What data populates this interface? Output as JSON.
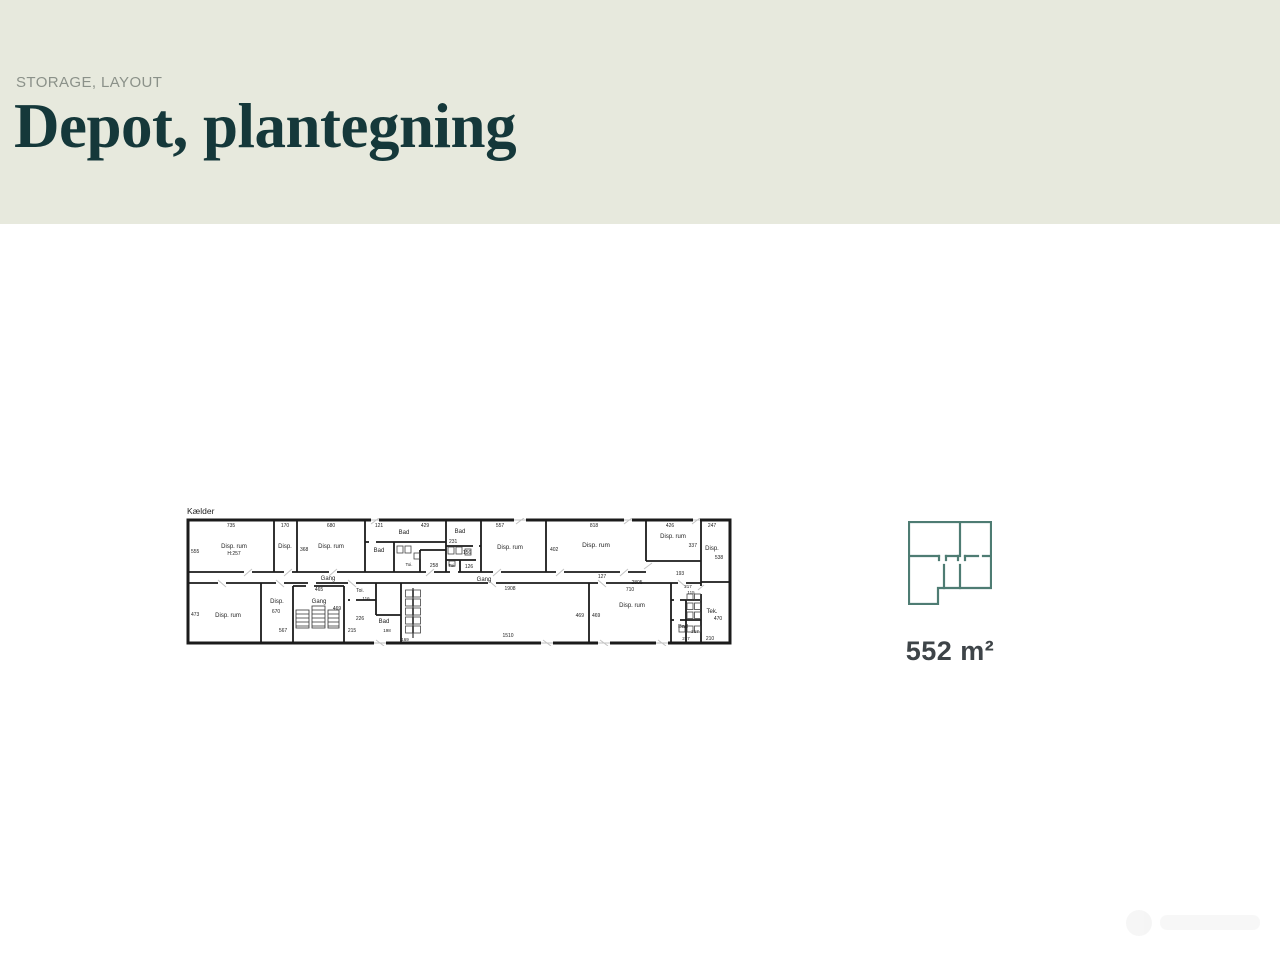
{
  "header": {
    "eyebrow": "STORAGE, LAYOUT",
    "title": "Depot, plantegning",
    "background": "#e7e9dd",
    "eyebrow_color": "#8b9189",
    "title_color": "#15383a"
  },
  "floorplan": {
    "name_label": "Kælder",
    "line_color": "#1b1b1b",
    "labels": [
      {
        "t": "735",
        "x": 43,
        "y": 7,
        "s": 5
      },
      {
        "t": "555",
        "x": 3,
        "y": 33,
        "s": 5,
        "a": "start"
      },
      {
        "t": "Disp. rum",
        "x": 46,
        "y": 28,
        "s": 6
      },
      {
        "t": "H:257",
        "x": 46,
        "y": 35,
        "s": 5
      },
      {
        "t": "170",
        "x": 97,
        "y": 7,
        "s": 5
      },
      {
        "t": "Disp.",
        "x": 97,
        "y": 28,
        "s": 6
      },
      {
        "t": "368",
        "x": 112,
        "y": 31,
        "s": 5,
        "a": "start"
      },
      {
        "t": "680",
        "x": 143,
        "y": 7,
        "s": 5
      },
      {
        "t": "Disp. rum",
        "x": 143,
        "y": 28,
        "s": 6
      },
      {
        "t": "121",
        "x": 191,
        "y": 7,
        "s": 5
      },
      {
        "t": "Bad",
        "x": 216,
        "y": 14,
        "s": 6
      },
      {
        "t": "429",
        "x": 237,
        "y": 7,
        "s": 5
      },
      {
        "t": "Bad",
        "x": 191,
        "y": 32,
        "s": 6
      },
      {
        "t": "Toi.",
        "x": 221,
        "y": 46,
        "s": 4.5
      },
      {
        "t": "258",
        "x": 246,
        "y": 47,
        "s": 5
      },
      {
        "t": "Bad",
        "x": 272,
        "y": 13,
        "s": 6
      },
      {
        "t": "231",
        "x": 261,
        "y": 23,
        "s": 5,
        "a": "start"
      },
      {
        "t": "156",
        "x": 279,
        "y": 34,
        "s": 5
      },
      {
        "t": "Toi.",
        "x": 264,
        "y": 47,
        "s": 4.5
      },
      {
        "t": "126",
        "x": 281,
        "y": 48,
        "s": 5
      },
      {
        "t": "557",
        "x": 312,
        "y": 7,
        "s": 5
      },
      {
        "t": "Disp. rum",
        "x": 322,
        "y": 29,
        "s": 6
      },
      {
        "t": "402",
        "x": 362,
        "y": 31,
        "s": 5,
        "a": "start"
      },
      {
        "t": "818",
        "x": 406,
        "y": 7,
        "s": 5
      },
      {
        "t": "Disp. rum",
        "x": 408,
        "y": 27,
        "s": 6.5
      },
      {
        "t": "426",
        "x": 482,
        "y": 7,
        "s": 5
      },
      {
        "t": "Disp. rum",
        "x": 485,
        "y": 18,
        "s": 6
      },
      {
        "t": "337",
        "x": 509,
        "y": 27,
        "s": 5,
        "a": "end"
      },
      {
        "t": "247",
        "x": 524,
        "y": 7,
        "s": 5
      },
      {
        "t": "Disp.",
        "x": 524,
        "y": 30,
        "s": 6
      },
      {
        "t": "538",
        "x": 531,
        "y": 39,
        "s": 5
      },
      {
        "t": "Gang",
        "x": 140,
        "y": 60,
        "s": 6
      },
      {
        "t": "Gang",
        "x": 296,
        "y": 61,
        "s": 6
      },
      {
        "t": "127",
        "x": 414,
        "y": 58,
        "s": 5
      },
      {
        "t": "2805",
        "x": 449,
        "y": 64,
        "s": 5
      },
      {
        "t": "193",
        "x": 492,
        "y": 55,
        "s": 5
      },
      {
        "t": "1908",
        "x": 322,
        "y": 70,
        "s": 5
      },
      {
        "t": "473",
        "x": 3,
        "y": 96,
        "s": 5,
        "a": "start"
      },
      {
        "t": "Disp. rum",
        "x": 40,
        "y": 97,
        "s": 6
      },
      {
        "t": "Disp.",
        "x": 89,
        "y": 83,
        "s": 6
      },
      {
        "t": "670",
        "x": 88,
        "y": 93,
        "s": 5
      },
      {
        "t": "567",
        "x": 95,
        "y": 112,
        "s": 5
      },
      {
        "t": "465",
        "x": 131,
        "y": 71,
        "s": 5
      },
      {
        "t": "Gang",
        "x": 131,
        "y": 83,
        "s": 6
      },
      {
        "t": "469",
        "x": 149,
        "y": 90,
        "s": 5
      },
      {
        "t": "Toi.",
        "x": 172,
        "y": 72,
        "s": 5
      },
      {
        "t": "116",
        "x": 178,
        "y": 80,
        "s": 4.5
      },
      {
        "t": "226",
        "x": 172,
        "y": 100,
        "s": 5
      },
      {
        "t": "215",
        "x": 164,
        "y": 112,
        "s": 5
      },
      {
        "t": "Bad",
        "x": 196,
        "y": 103,
        "s": 6
      },
      {
        "t": "198",
        "x": 199,
        "y": 112,
        "s": 4.5
      },
      {
        "t": "169",
        "x": 217,
        "y": 121,
        "s": 4.5
      },
      {
        "t": "469",
        "x": 396,
        "y": 97,
        "s": 5,
        "a": "end"
      },
      {
        "t": "469",
        "x": 404,
        "y": 97,
        "s": 5,
        "a": "start"
      },
      {
        "t": "710",
        "x": 442,
        "y": 71,
        "s": 5
      },
      {
        "t": "Disp. rum",
        "x": 444,
        "y": 87,
        "s": 6
      },
      {
        "t": "1510",
        "x": 320,
        "y": 117,
        "s": 5
      },
      {
        "t": "217",
        "x": 500,
        "y": 68,
        "s": 4.5
      },
      {
        "t": "115",
        "x": 503,
        "y": 74,
        "s": 4.5
      },
      {
        "t": "Bad",
        "x": 495,
        "y": 108,
        "s": 5.5
      },
      {
        "t": "217",
        "x": 507,
        "y": 113,
        "s": 4.5
      },
      {
        "t": "217",
        "x": 498,
        "y": 120,
        "s": 4.5
      },
      {
        "t": "Tek.",
        "x": 524,
        "y": 93,
        "s": 6
      },
      {
        "t": "470",
        "x": 530,
        "y": 100,
        "s": 5
      },
      {
        "t": "210",
        "x": 522,
        "y": 120,
        "s": 5
      }
    ]
  },
  "summary": {
    "area_label": "552 m²",
    "icon_color": "#4e7c73",
    "text_color": "#3e4448"
  }
}
